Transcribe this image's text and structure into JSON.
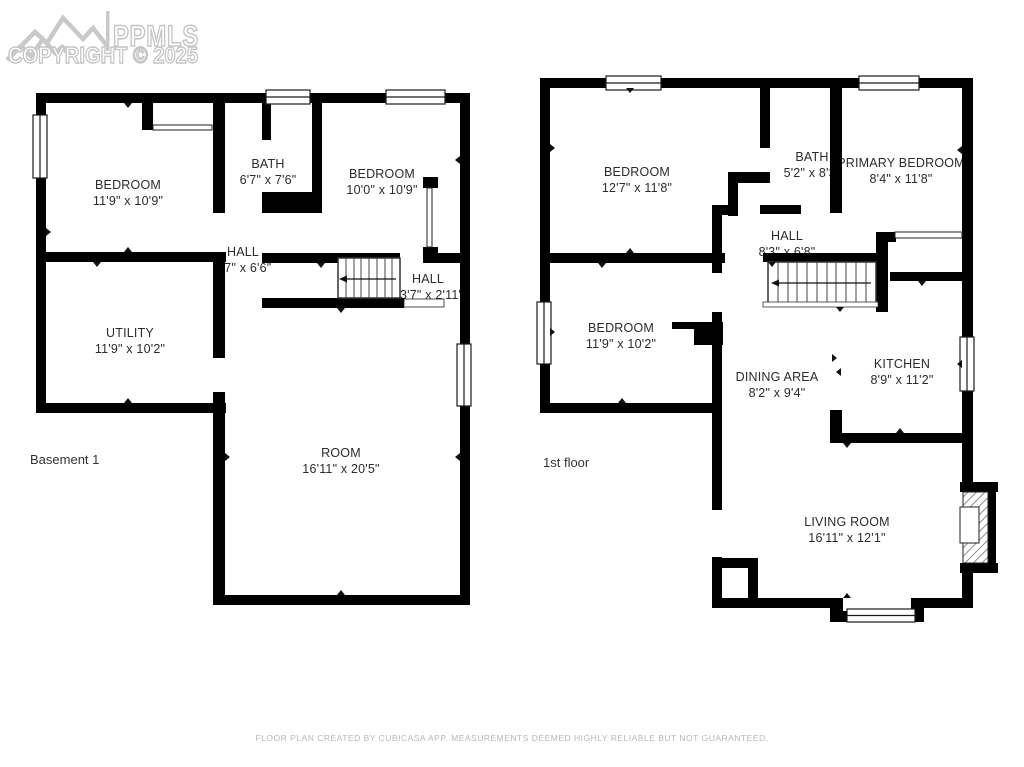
{
  "watermark": {
    "brand": "PPMLS",
    "copyright": "COPYRIGHT © 2025"
  },
  "floors": [
    {
      "label": "Basement 1",
      "rooms": [
        {
          "name": "BEDROOM",
          "dims": "11'9\" x 10'9\""
        },
        {
          "name": "BATH",
          "dims": "6'7\" x 7'6\""
        },
        {
          "name": "BEDROOM",
          "dims": "10'0\" x 10'9\""
        },
        {
          "name": "HALL",
          "dims": "6'7\" x 6'6\""
        },
        {
          "name": "HALL",
          "dims": "13'7\" x 2'11\""
        },
        {
          "name": "UTILITY",
          "dims": "11'9\" x 10'2\""
        },
        {
          "name": "ROOM",
          "dims": "16'11\" x 20'5\""
        }
      ]
    },
    {
      "label": "1st floor",
      "rooms": [
        {
          "name": "BEDROOM",
          "dims": "12'7\" x 11'8\""
        },
        {
          "name": "BATH",
          "dims": "5'2\" x 8'3\""
        },
        {
          "name": "PRIMARY BEDROOM",
          "dims": "8'4\" x 11'8\""
        },
        {
          "name": "HALL",
          "dims": "8'3\" x 6'8\""
        },
        {
          "name": "BEDROOM",
          "dims": "11'9\" x 10'2\""
        },
        {
          "name": "DINING AREA",
          "dims": "8'2\" x 9'4\""
        },
        {
          "name": "KITCHEN",
          "dims": "8'9\" x 11'2\""
        },
        {
          "name": "LIVING ROOM",
          "dims": "16'11\" x 12'1\""
        }
      ]
    }
  ],
  "footer": "FLOOR PLAN CREATED BY CUBICASA APP. MEASUREMENTS DEEMED HIGHLY RELIABLE BUT NOT GUARANTEED."
}
